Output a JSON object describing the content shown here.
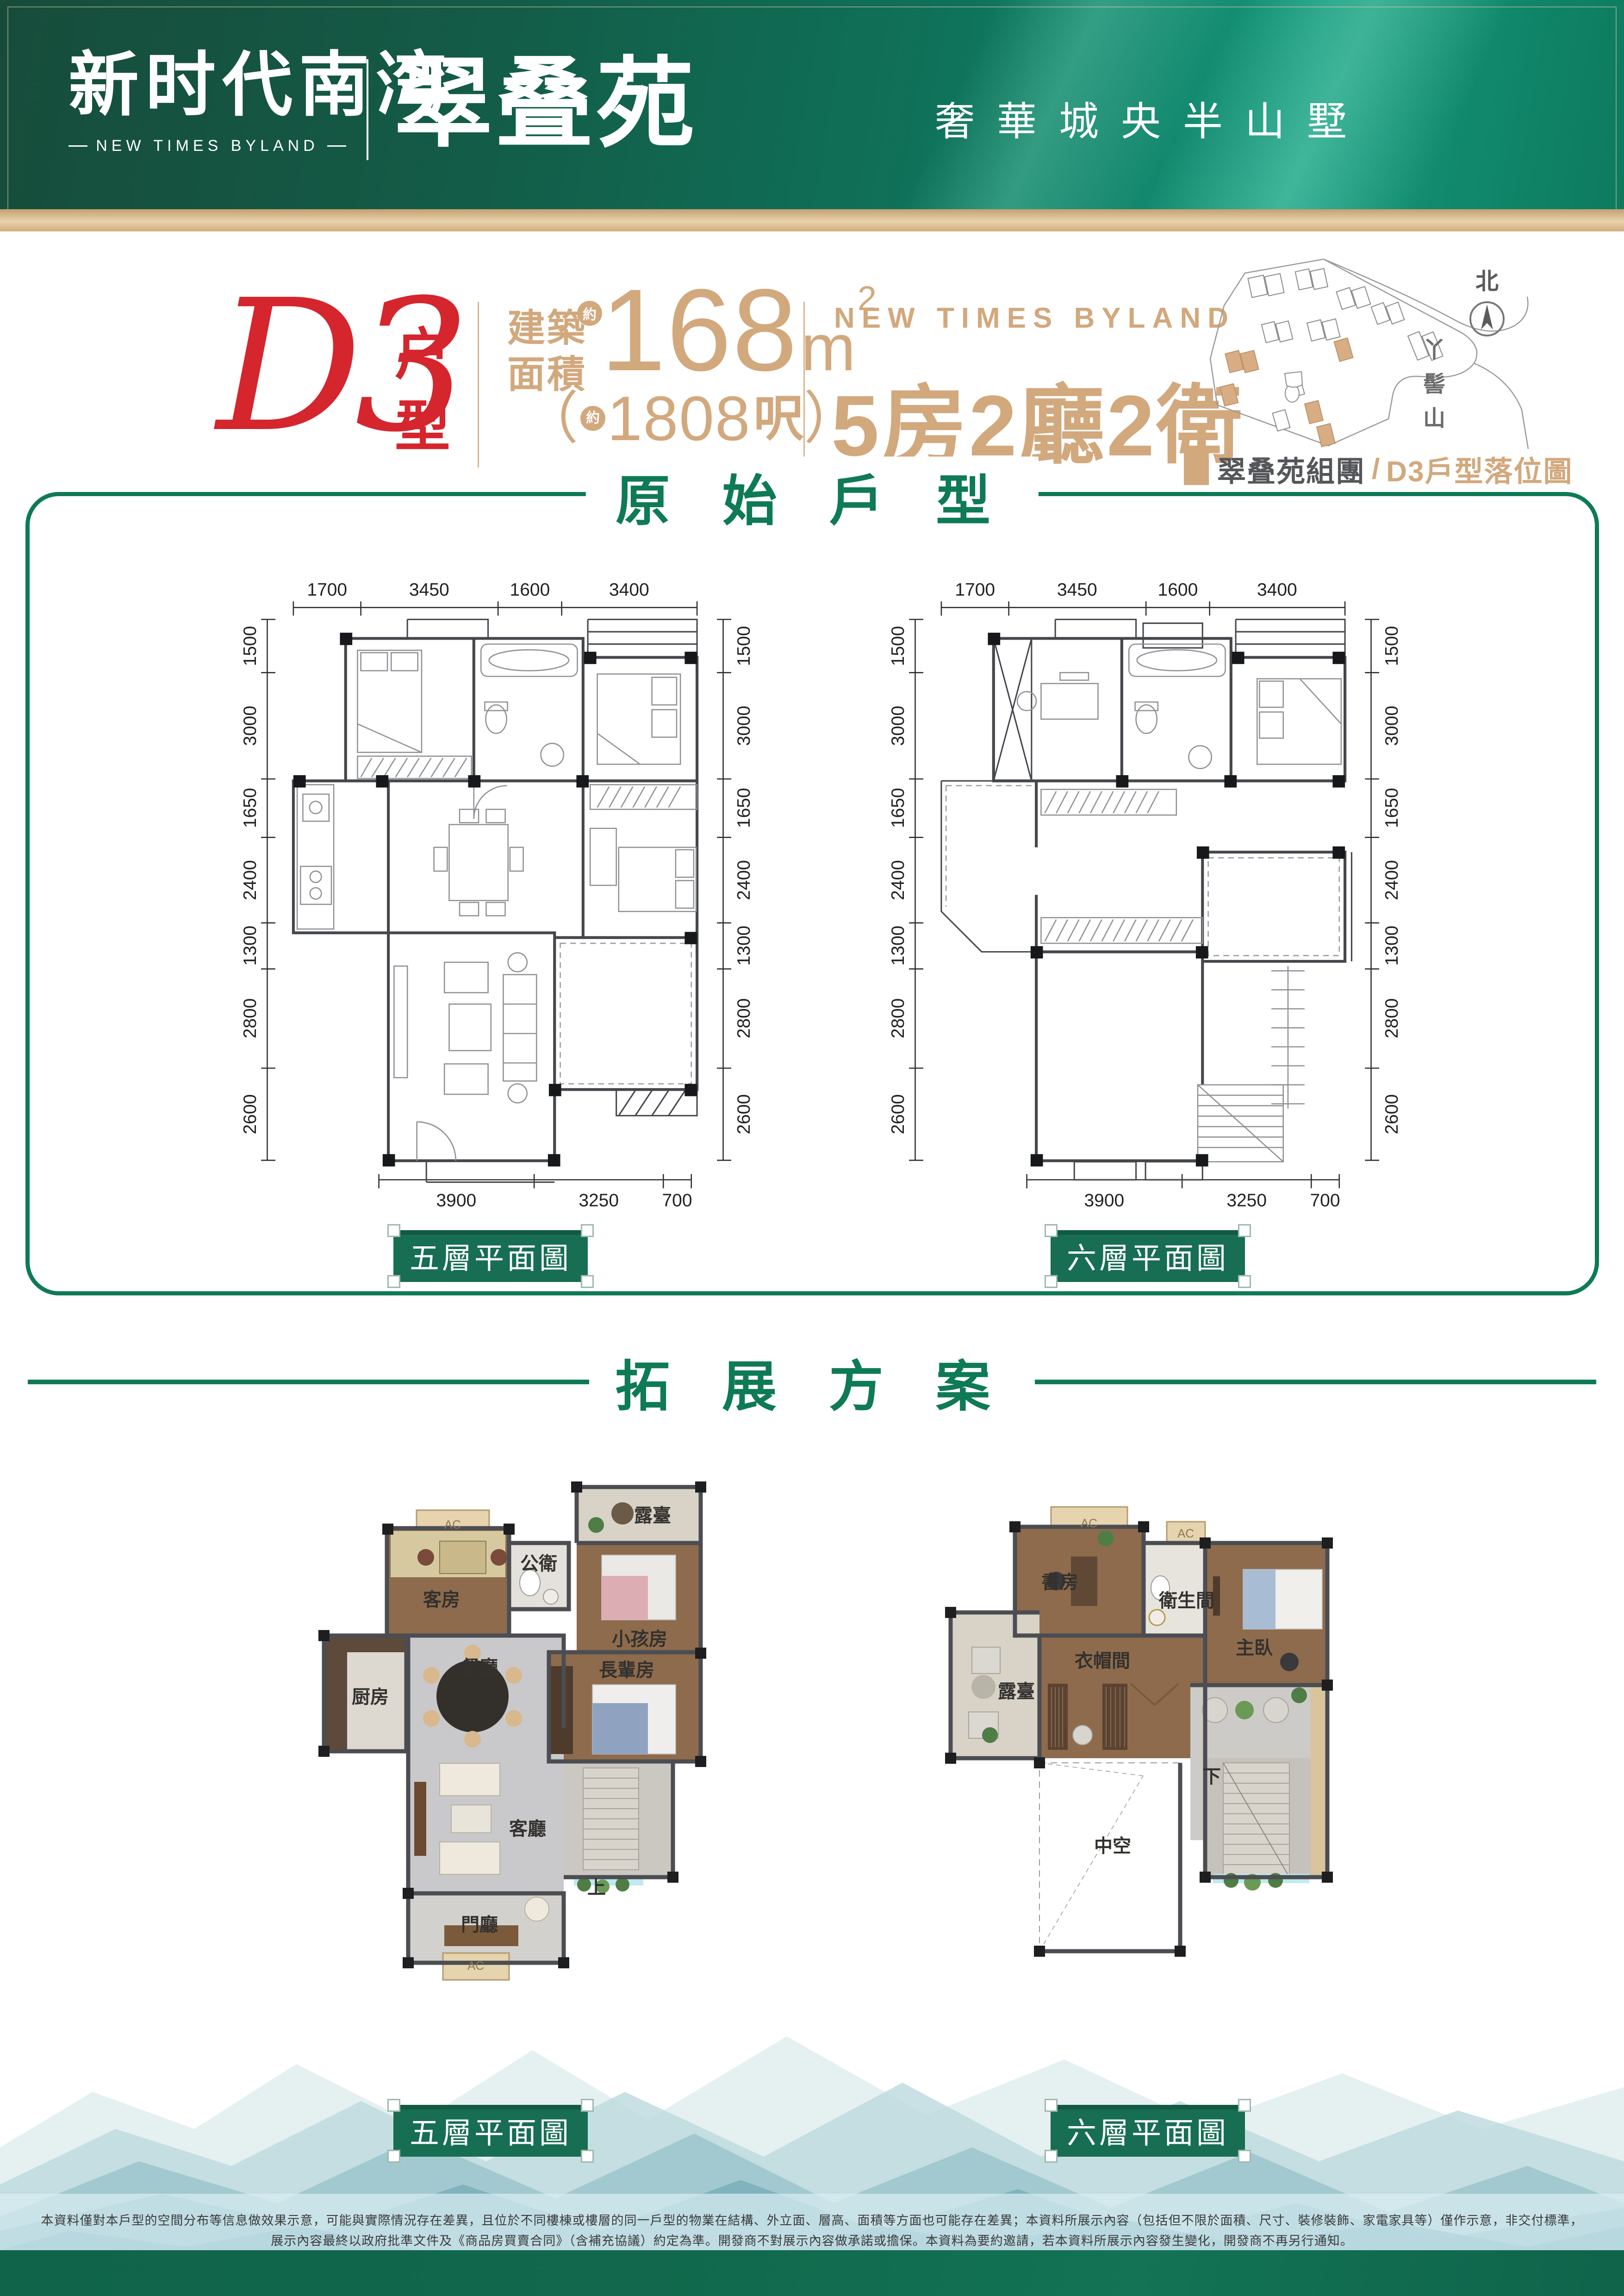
{
  "colors": {
    "green": "#0e7a56",
    "label_green": "#176e52",
    "tan": "#d2a87d",
    "red": "#d5252d",
    "wall": "#4b4d52"
  },
  "header": {
    "brand_cn": "新时代南湾",
    "brand_en": "NEW TIMES BYLAND",
    "project": "翠叠苑",
    "tagline": "奢華城央半山墅"
  },
  "unit": {
    "code": "D3",
    "code_suffix_1": "户",
    "code_suffix_2": "型",
    "area_label_1": "建築",
    "area_label_2": "面積",
    "approx": "約",
    "area_value": "168",
    "area_unit": "m",
    "area_exp": "2",
    "alt_open": "（",
    "alt_value": "1808",
    "alt_unit": "呎",
    "alt_close": "）",
    "brand_en": "NEW TIMES BYLAND",
    "layout": "5房2廳2衛"
  },
  "sitemap": {
    "north": "北",
    "mountain": "丫髻山",
    "legend_group": "翠叠苑組團",
    "legend_sep": "/",
    "legend_unit": "D3戶型落位圖"
  },
  "section1": {
    "title": "原 始 戶 型",
    "top_dims": [
      "1700",
      "3450",
      "1600",
      "3400"
    ],
    "side_dims": [
      "1500",
      "3000",
      "1650",
      "2400",
      "1300",
      "2800",
      "2600"
    ],
    "bottom_dims": [
      "3900",
      "3250",
      "700"
    ],
    "plan_labels": [
      "五層平面圖",
      "六層平面圖"
    ]
  },
  "section2": {
    "title": "拓 展 方 案",
    "plan_labels": [
      "五層平面圖",
      "六層平面圖"
    ],
    "ac": "AC",
    "plan5_rooms": {
      "guest": "客房",
      "bath": "公衛",
      "terrace": "露臺",
      "kids": "小孩房",
      "dining": "餐廳",
      "kitchen": "厨房",
      "elder": "長輩房",
      "living": "客廳",
      "up": "上",
      "foyer": "門廳"
    },
    "plan6_rooms": {
      "study": "書房",
      "bath": "衛生間",
      "master": "主臥",
      "closet": "衣帽間",
      "terrace": "露臺",
      "down": "下",
      "void": "中空"
    }
  },
  "disclaimer": {
    "line1": "本資料僅對本戶型的空間分布等信息做效果示意，可能與實際情況存在差異，且位於不同樓棟或樓層的同一戶型的物業在結構、外立面、層高、面積等方面也可能存在差異；本資料所展示內容（包括但不限於面積、尺寸、裝修裝飾、家電家具等）僅作示意，非交付標準，",
    "line2": "展示內容最終以政府批準文件及《商品房買賣合同》（含補充協議）約定為準。開發商不對展示內容做承諾或擔保。本資料為要約邀請，若本資料所展示內容發生變化，開發商不再另行通知。"
  }
}
